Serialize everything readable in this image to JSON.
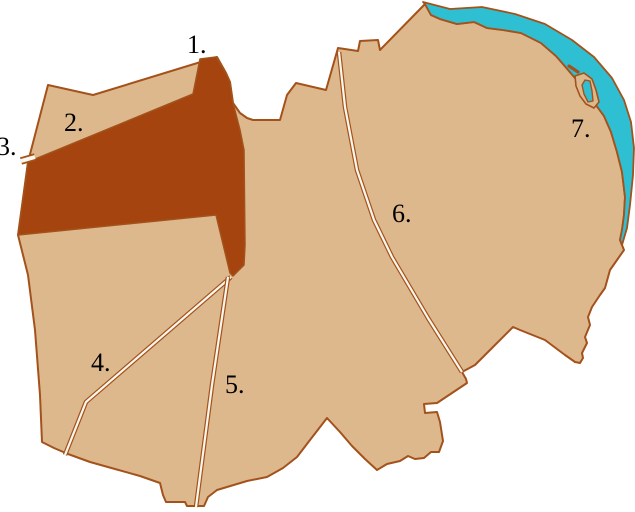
{
  "map": {
    "kind": "district-quarters-map",
    "labels": [
      {
        "id": 1,
        "text": "1.",
        "x": 187,
        "y": 53
      },
      {
        "id": 2,
        "text": "2.",
        "x": 64,
        "y": 131
      },
      {
        "id": 3,
        "text": "3.",
        "x": -3,
        "y": 155
      },
      {
        "id": 4,
        "text": "4.",
        "x": 91,
        "y": 371
      },
      {
        "id": 5,
        "text": "5.",
        "x": 225,
        "y": 393
      },
      {
        "id": 6,
        "text": "6.",
        "x": 392,
        "y": 222
      },
      {
        "id": 7,
        "text": "7.",
        "x": 571,
        "y": 137
      }
    ],
    "colors": {
      "background": "#ffffff",
      "land": "#deb88d",
      "highlight": "#a5440e",
      "water": "#2fbfd2",
      "road": "#fdf8ef",
      "outline": "#a3521b",
      "label": "#000000"
    }
  }
}
